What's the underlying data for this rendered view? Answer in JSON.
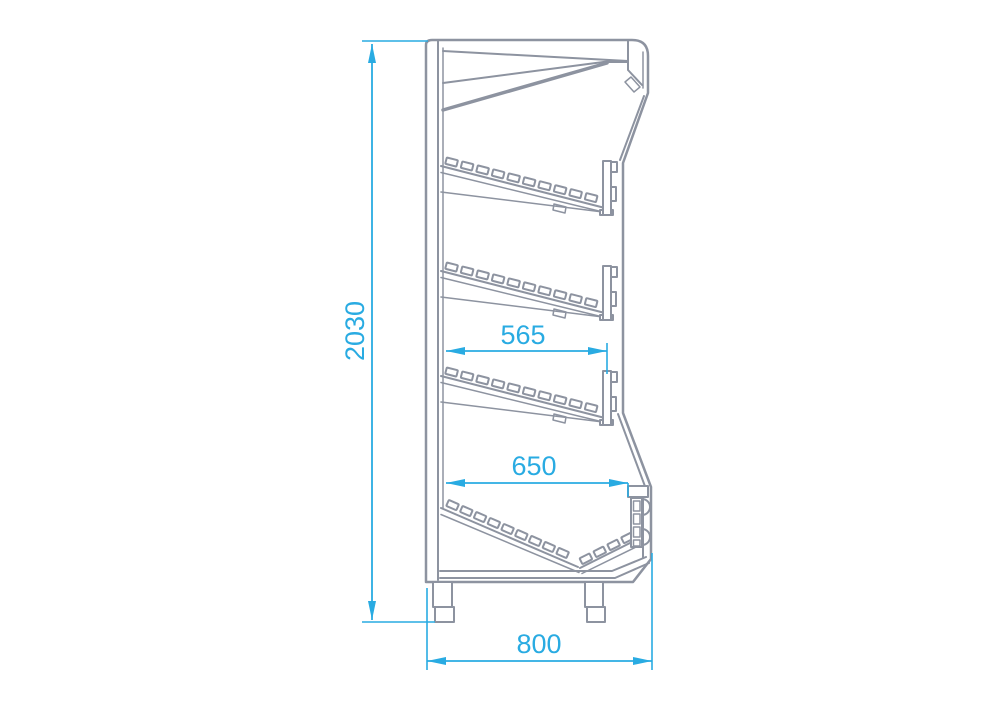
{
  "drawing": {
    "dimensions": {
      "height": {
        "value": "2030"
      },
      "shelf_depth": {
        "value": "565"
      },
      "well_depth": {
        "value": "650"
      },
      "overall_depth": {
        "value": "800"
      }
    },
    "colors": {
      "outline": "#8d93a0",
      "dimension": "#29abe2",
      "background": "#ffffff"
    }
  }
}
